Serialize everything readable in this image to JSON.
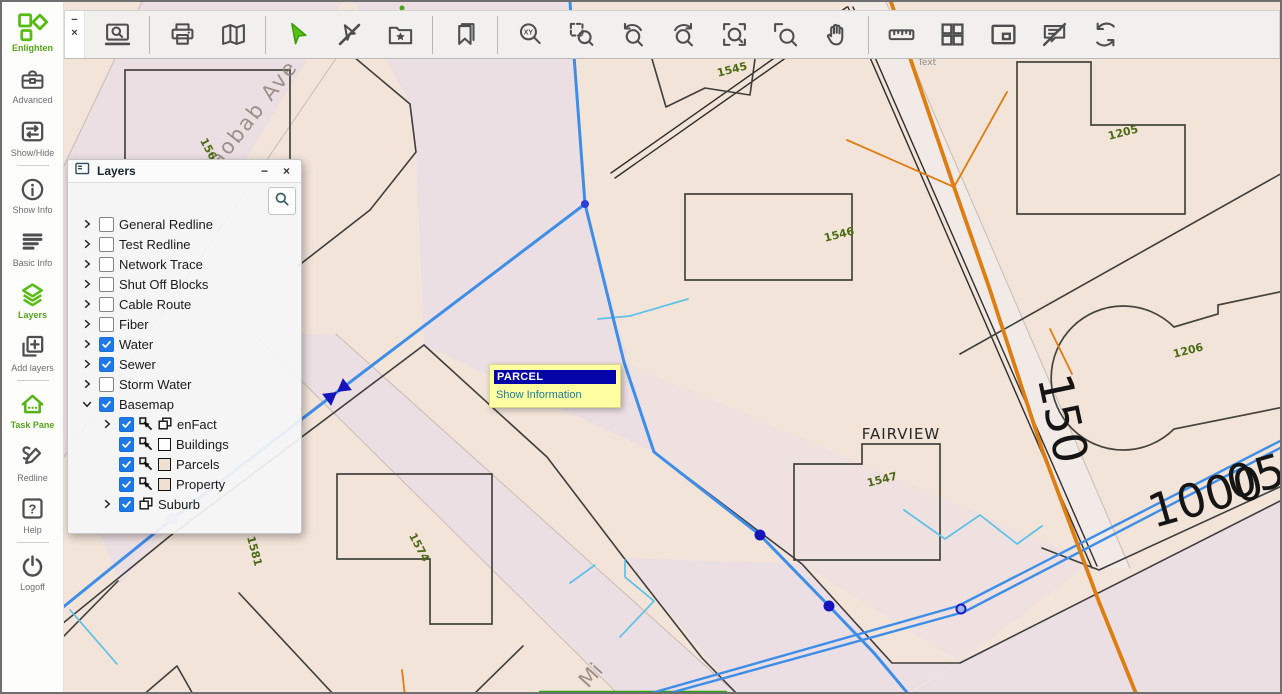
{
  "sidebar": {
    "items": [
      {
        "label": "Enlighten",
        "icon": "enlighten-logo",
        "active": true
      },
      {
        "label": "Advanced",
        "icon": "toolbox"
      },
      {
        "label": "Show/Hide",
        "icon": "show-hide",
        "divider_after": true
      },
      {
        "label": "Show Info",
        "icon": "info-circle"
      },
      {
        "label": "Basic Info",
        "icon": "list-lines"
      },
      {
        "label": "Layers",
        "icon": "layers-stack",
        "active": true
      },
      {
        "label": "Add layers",
        "icon": "add-layers",
        "divider_after": true
      },
      {
        "label": "Task Pane",
        "icon": "house-task",
        "active": true
      },
      {
        "label": "Redline",
        "icon": "pencil-scribble"
      },
      {
        "label": "Help",
        "icon": "question-square",
        "divider_after": true
      },
      {
        "label": "Logoff",
        "icon": "power"
      }
    ]
  },
  "toolbar": {
    "window_controls": {
      "minimize": "−",
      "close": "×"
    },
    "groups": [
      [
        "find-on-map"
      ],
      [
        "print",
        "map"
      ],
      [
        "select",
        "clear-selection",
        "add-to-favorites"
      ],
      [
        "bookmarks"
      ],
      [
        "zoom-xy",
        "zoom-window",
        "zoom-previous",
        "zoom-next",
        "zoom-extent",
        "zoom-selected",
        "pan"
      ],
      [
        "measure",
        "tile-layout",
        "overview-map",
        "hide-callouts",
        "refresh"
      ]
    ]
  },
  "layers_panel": {
    "title": "Layers",
    "controls": {
      "minimize": "−",
      "close": "×"
    },
    "accent": "#1e78e8",
    "items": [
      {
        "label": "General Redline",
        "checked": false
      },
      {
        "label": "Test Redline",
        "checked": false
      },
      {
        "label": "Network Trace",
        "checked": false
      },
      {
        "label": "Shut Off Blocks",
        "checked": false
      },
      {
        "label": "Cable Route",
        "checked": false
      },
      {
        "label": "Fiber",
        "checked": false
      },
      {
        "label": "Water",
        "checked": true
      },
      {
        "label": "Sewer",
        "checked": true
      },
      {
        "label": "Storm Water",
        "checked": false
      },
      {
        "label": "Basemap",
        "checked": true,
        "expanded": true,
        "children": [
          {
            "label": "enFact",
            "checked": true,
            "chevron": true,
            "icons": [
              "cursor",
              "copy"
            ]
          },
          {
            "label": "Buildings",
            "checked": true,
            "icons": [
              "cursor"
            ],
            "swatch": "white"
          },
          {
            "label": "Parcels",
            "checked": true,
            "icons": [
              "cursor"
            ],
            "swatch": "beige"
          },
          {
            "label": "Property",
            "checked": true,
            "icons": [
              "cursor"
            ],
            "swatch": "beige"
          },
          {
            "label": "Suburb",
            "checked": true,
            "chevron": true,
            "icons": [
              "copy"
            ]
          }
        ]
      }
    ]
  },
  "tooltip": {
    "title": "PARCEL",
    "link": "Show Information",
    "colors": {
      "background": "#feffa0",
      "title_bar": "#0404a8",
      "link": "#1b7d9b"
    }
  },
  "map": {
    "colors": {
      "base": "#f2e4d9",
      "street": "#ecdfe3",
      "road_light": "#f1eae7",
      "parcel_line": "#3e3e3e",
      "faint_line": "#c9bcb4",
      "building_line": "#45453e",
      "water": "#3e8ee8",
      "water_node": "#1515bb",
      "storm": "#5ec1e8",
      "power": "#dd7d12",
      "sewer": "#2fa312",
      "number": "#4c6b15",
      "street_text": "#8b7f76",
      "big_text": "#151515"
    },
    "street_labels": [
      {
        "text": "Baobab Ave",
        "x": 252,
        "y": 122,
        "rot": -52,
        "size": 21,
        "cls": "street",
        "ls": 2
      },
      {
        "text": "Mi",
        "x": 594,
        "y": 678,
        "rot": -48,
        "size": 21,
        "cls": "street"
      },
      {
        "text": "FAIRVIEW",
        "x": 899,
        "y": 437,
        "rot": 0,
        "size": 15,
        "cls": "suburb",
        "ls": 1
      },
      {
        "text": "150",
        "x": 1045,
        "y": 420,
        "rot": 78,
        "size": 47,
        "cls": "big"
      },
      {
        "text": "1000",
        "x": 1208,
        "y": 510,
        "rot": -16,
        "size": 46,
        "cls": "big"
      },
      {
        "text": "05",
        "x": 1258,
        "y": 490,
        "rot": -16,
        "size": 46,
        "cls": "big"
      },
      {
        "text": "Text",
        "x": 925,
        "y": 63,
        "rot": 0,
        "size": 9,
        "cls": "tiny"
      }
    ],
    "parcel_numbers": [
      {
        "text": "1565",
        "x": 205,
        "y": 152,
        "rot": 62
      },
      {
        "text": "1545",
        "x": 731,
        "y": 71,
        "rot": -14
      },
      {
        "text": "1546",
        "x": 838,
        "y": 236,
        "rot": -14
      },
      {
        "text": "1205",
        "x": 1122,
        "y": 134,
        "rot": -14
      },
      {
        "text": "1206",
        "x": 1187,
        "y": 352,
        "rot": -14
      },
      {
        "text": "1547",
        "x": 881,
        "y": 481,
        "rot": -14
      },
      {
        "text": "1574",
        "x": 414,
        "y": 547,
        "rot": 62
      },
      {
        "text": "1581",
        "x": 249,
        "y": 550,
        "rot": 75
      }
    ]
  }
}
